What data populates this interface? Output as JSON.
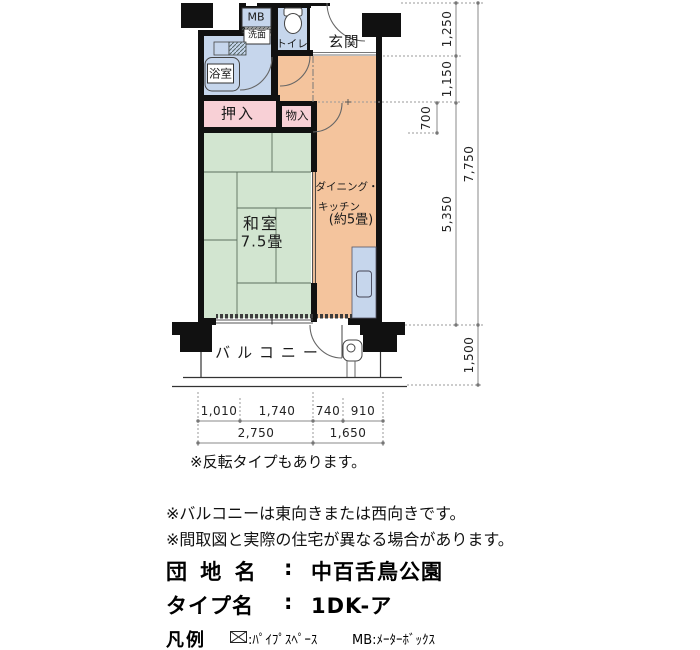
{
  "plan": {
    "rooms": {
      "mb_label": "MB",
      "washbasin": "洗面",
      "toilet": "トイレ",
      "entrance": "玄関",
      "bath": "浴室",
      "closet": "押入",
      "storage": "物入",
      "tatami_name": "和室",
      "tatami_size": "7.5畳",
      "dk_line1": "ダイニング・",
      "dk_line2": "キッチン",
      "dk_line3": "(約5畳)",
      "balcony": "バルコニー"
    },
    "dims_right": {
      "d1250": "1,250",
      "d1150": "1,150",
      "d700": "700",
      "d5350": "5,350",
      "d7750": "7,750",
      "d1500": "1,500"
    },
    "dims_bottom": {
      "d1010": "1,010",
      "d1740": "1,740",
      "d740": "740",
      "d910": "910",
      "d2750": "2,750",
      "d1650": "1,650"
    }
  },
  "notes": {
    "reverse": "※反転タイプもあります。",
    "balcony_direction": "※バルコニーは東向きまたは西向きです。",
    "difference": "※間取図と実際の住宅が異なる場合があります。"
  },
  "info": {
    "estate_label": "団 地 名",
    "estate_sep": ":",
    "estate_value": "中百舌鳥公園",
    "type_label": "タイプ名",
    "type_sep": ":",
    "type_value": "1DK-ア"
  },
  "legend": {
    "label": "凡例",
    "pipe_space": ":ﾊﾟｲﾌﾟｽﾍﾟｰｽ",
    "meter_box": "MB:ﾒｰﾀｰﾎﾞｯｸｽ"
  },
  "colors": {
    "wall": "#111111",
    "water_blue": "#c6d6ec",
    "dk_orange": "#f4c49d",
    "tatami_green": "#d2e5d0",
    "closet_pink": "#f8d0d6"
  }
}
